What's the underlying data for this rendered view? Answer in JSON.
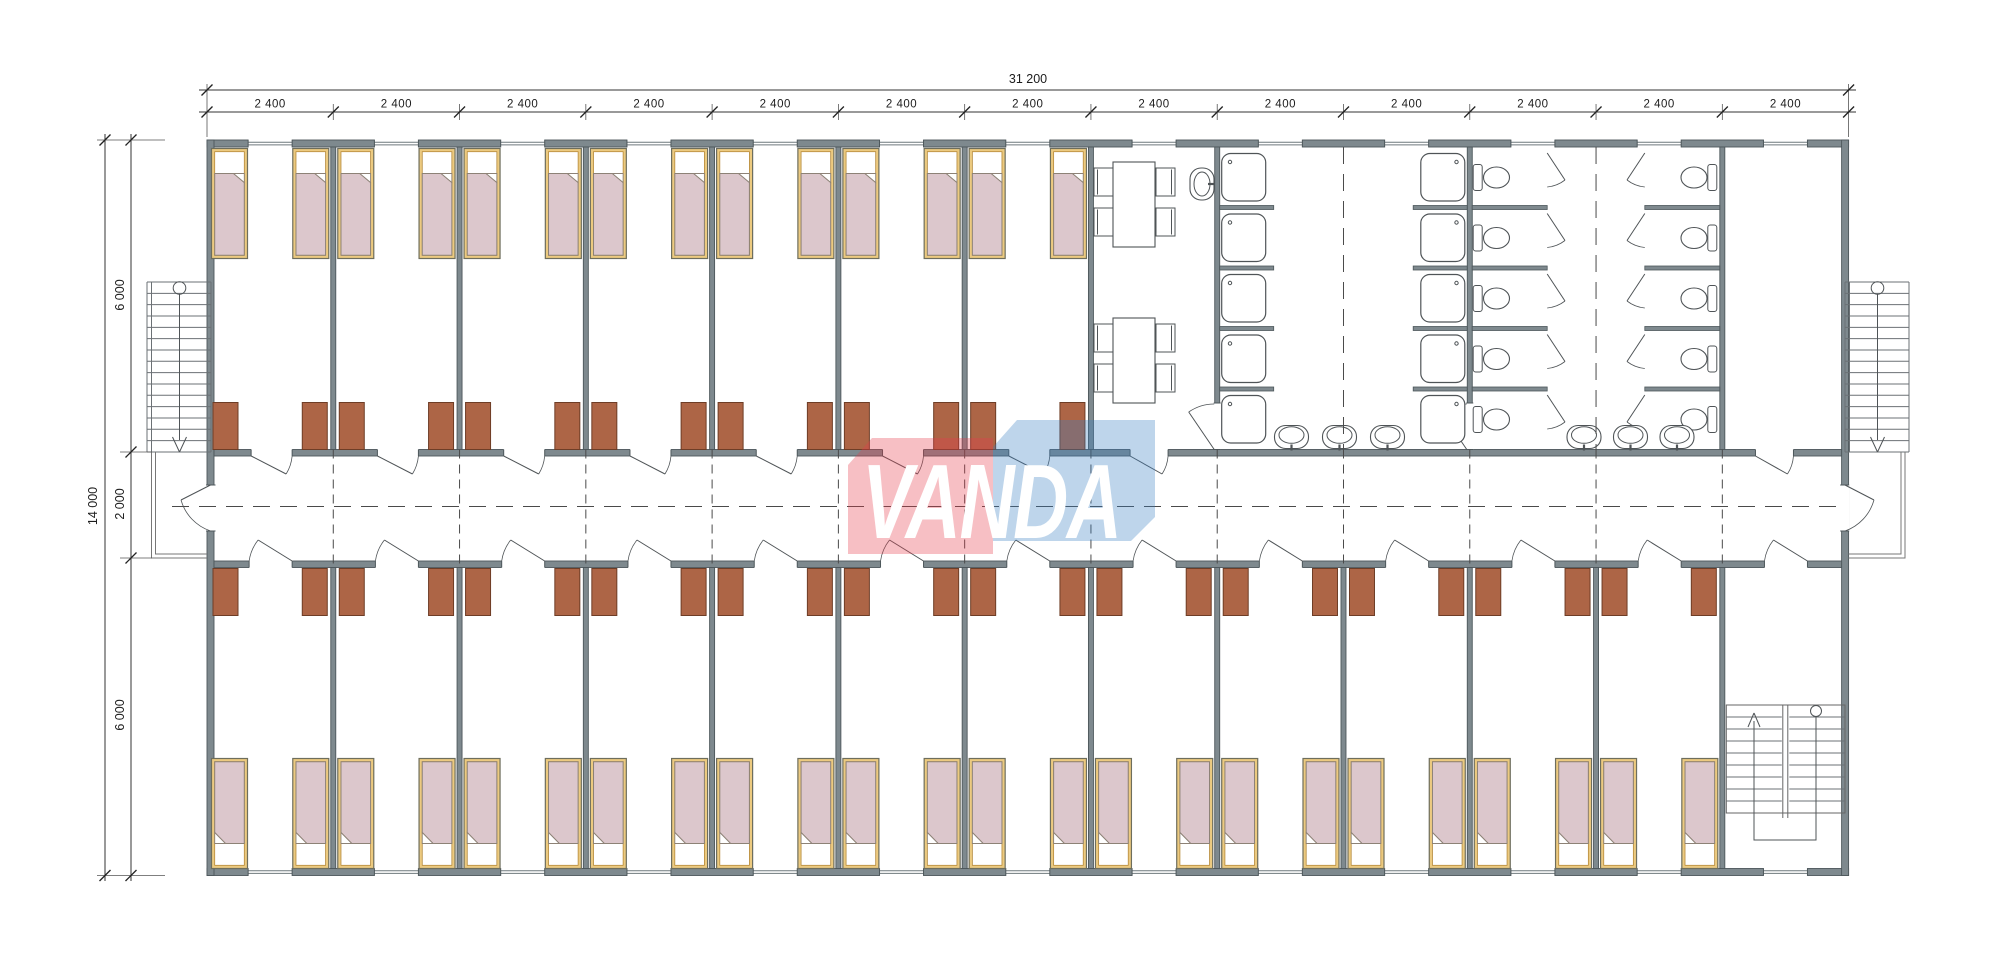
{
  "drawing": {
    "kind": "floor-plan"
  },
  "dimensions_top": {
    "overall_label": "31 200",
    "bay_label": "2 400",
    "bay_count": 13
  },
  "dimensions_left": {
    "overall_label": "14 000",
    "segment_labels": [
      "6 000",
      "2 000",
      "6 000"
    ]
  },
  "logo": {
    "text": "VANDA",
    "red_color": "#e83e4d",
    "blue_color": "#3a80c2"
  },
  "palette": {
    "wall_fill": "#7e898e",
    "wall_edge": "#4d575b",
    "fixture": "#4f5457",
    "stair_line": "#6b7175",
    "dash": "#4a4a4a",
    "bed_frame": "#ecca80",
    "bed_frame_edge": "#b5893a",
    "bed_outline": "#6e6e5d",
    "mattress": "#dcc7cc",
    "mattress_edge": "#8d8276",
    "wardrobe": "#ad6546",
    "wardrobe_edge": "#6e3d26",
    "dim": "#1c1c1c",
    "glaze": "#6f797d"
  },
  "inventory": {
    "top_bedrooms": 7,
    "bottom_bedrooms": 12,
    "beds_per_bedroom": 2,
    "wardrobes_per_bedroom": 2,
    "dining_tables": 2,
    "chairs_per_table": 4,
    "shower_stalls": 10,
    "toilet_stalls": 10,
    "wash_basins": 7,
    "external_staircases": 2,
    "internal_staircases": 1
  }
}
